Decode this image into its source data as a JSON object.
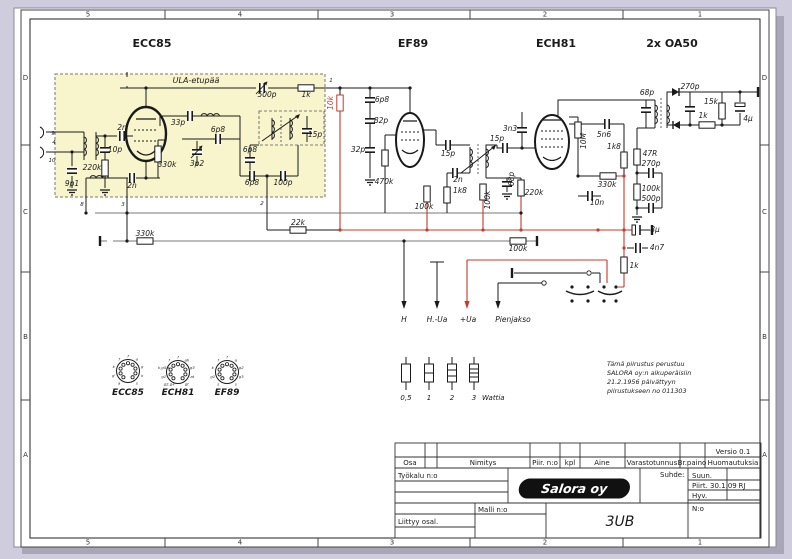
{
  "frame": {
    "zones_top": [
      "5",
      "4",
      "3",
      "2",
      "1"
    ],
    "zones_bottom": [
      "5",
      "4",
      "3",
      "2",
      "1"
    ],
    "zones_left": [
      "D",
      "C",
      "B",
      "A"
    ],
    "zones_right": [
      "D",
      "C",
      "B",
      "A"
    ]
  },
  "tube_titles": [
    {
      "t": "ECC85",
      "x": 152
    },
    {
      "t": "EF89",
      "x": 413
    },
    {
      "t": "ECH81",
      "x": 556
    },
    {
      "t": "2x OA50",
      "x": 672
    }
  ],
  "ula_label": "ULA-etupää",
  "labels": [
    {
      "t": "500p",
      "x": 267,
      "y": 97,
      "sym": "vcaph",
      "sx": 262,
      "sy": 88
    },
    {
      "t": "1k",
      "x": 306,
      "y": 97,
      "sym": "resh",
      "sx": 306,
      "sy": 88
    },
    {
      "t": "10k",
      "x": 333,
      "y": 103,
      "r": -90,
      "c": "red",
      "sym": "resv",
      "sx": 340,
      "sy": 103
    },
    {
      "t": "33p",
      "x": 178,
      "y": 125,
      "sym": "caph",
      "sx": 190,
      "sy": 116
    },
    {
      "t": "6p8",
      "x": 218,
      "y": 132,
      "sym": "caph",
      "sx": 218,
      "sy": 139
    },
    {
      "t": "15p",
      "x": 315,
      "y": 137,
      "sym": "capv",
      "sx": 307,
      "sy": 131
    },
    {
      "t": "2n",
      "x": 122,
      "y": 130,
      "sym": "caph",
      "sx": 122,
      "sy": 136
    },
    {
      "t": "10p",
      "x": 115,
      "y": 152,
      "sym": "capv",
      "sx": 105,
      "sy": 150
    },
    {
      "t": "220k",
      "x": 92,
      "y": 170,
      "sym": "resv",
      "sx": 105,
      "sy": 168
    },
    {
      "t": "330k",
      "x": 167,
      "y": 167,
      "sym": "resv",
      "sx": 158,
      "sy": 154
    },
    {
      "t": "3p2",
      "x": 197,
      "y": 166,
      "sym": "vcapv",
      "sx": 197,
      "sy": 152
    },
    {
      "t": "9p1",
      "x": 72,
      "y": 186,
      "sym": "capv",
      "sx": 72,
      "sy": 171
    },
    {
      "t": "2n",
      "x": 132,
      "y": 188,
      "sym": "caph",
      "sx": 132,
      "sy": 178
    },
    {
      "t": "6p8",
      "x": 250,
      "y": 152,
      "sym": "capv",
      "sx": 250,
      "sy": 160
    },
    {
      "t": "6p8",
      "x": 252,
      "y": 185,
      "sym": "caph",
      "sx": 252,
      "sy": 176
    },
    {
      "t": "100p",
      "x": 283,
      "y": 185,
      "sym": "caph",
      "sx": 283,
      "sy": 176
    },
    {
      "t": "6p8",
      "x": 382,
      "y": 102,
      "sym": "capv",
      "sx": 370,
      "sy": 100
    },
    {
      "t": "82p",
      "x": 381,
      "y": 123,
      "sym": "capv",
      "sx": 370,
      "sy": 121
    },
    {
      "t": "32p",
      "x": 358,
      "y": 152,
      "sym": "capv",
      "sx": 370,
      "sy": 150
    },
    {
      "t": "470k",
      "x": 384,
      "y": 184,
      "sym": "resv",
      "sx": 385,
      "sy": 158
    },
    {
      "t": "100k",
      "x": 424,
      "y": 209,
      "sym": "resv",
      "sx": 427,
      "sy": 194
    },
    {
      "t": "15p",
      "x": 448,
      "y": 156,
      "sym": "caph",
      "sx": 448,
      "sy": 145
    },
    {
      "t": "2n",
      "x": 458,
      "y": 182,
      "sym": "caph",
      "sx": 455,
      "sy": 173
    },
    {
      "t": "1k8",
      "x": 460,
      "y": 193,
      "sym": "resv",
      "sx": 447,
      "sy": 195
    },
    {
      "t": "100k",
      "x": 490,
      "y": 200,
      "r": -90,
      "sym": "resv",
      "sx": 483,
      "sy": 192
    },
    {
      "t": "15p",
      "x": 497,
      "y": 141,
      "sym": "caph",
      "sx": 505,
      "sy": 148
    },
    {
      "t": "3n3",
      "x": 510,
      "y": 131,
      "sym": "capv",
      "sx": 522,
      "sy": 130
    },
    {
      "t": "68p",
      "x": 514,
      "y": 179,
      "r": -90,
      "sym": "capv",
      "sx": 507,
      "sy": 184
    },
    {
      "t": "220k",
      "x": 534,
      "y": 195,
      "sym": "resv",
      "sx": 521,
      "sy": 188
    },
    {
      "t": "10M",
      "x": 586,
      "y": 141,
      "r": -90,
      "sym": "resv",
      "sx": 578,
      "sy": 130
    },
    {
      "t": "5n6",
      "x": 604,
      "y": 137,
      "sym": "caph",
      "sx": 607,
      "sy": 124
    },
    {
      "t": "1k8",
      "x": 614,
      "y": 149,
      "sym": "resv",
      "sx": 624,
      "sy": 160
    },
    {
      "t": "330k",
      "x": 607,
      "y": 187,
      "sym": "resh",
      "sx": 608,
      "sy": 176
    },
    {
      "t": "10n",
      "x": 597,
      "y": 205,
      "sym": "caph",
      "sx": 590,
      "sy": 196
    },
    {
      "t": "68p",
      "x": 647,
      "y": 95,
      "sym": "capv",
      "sx": 646,
      "sy": 110
    },
    {
      "t": "270p",
      "x": 690,
      "y": 89,
      "sym": "capv",
      "sx": 690,
      "sy": 109
    },
    {
      "t": "15k",
      "x": 711,
      "y": 104,
      "sym": "resv",
      "sx": 722,
      "sy": 111
    },
    {
      "t": "1k",
      "x": 703,
      "y": 118,
      "sym": "resh",
      "sx": 707,
      "sy": 125
    },
    {
      "t": "4μ",
      "x": 748,
      "y": 121,
      "sym": "polv",
      "sx": 740,
      "sy": 109
    },
    {
      "t": "47R",
      "x": 650,
      "y": 156,
      "sym": "resv",
      "sx": 637,
      "sy": 157
    },
    {
      "t": "270p",
      "x": 651,
      "y": 166,
      "sym": "caph",
      "sx": 651,
      "sy": 173
    },
    {
      "t": "100k",
      "x": 651,
      "y": 191,
      "sym": "resv",
      "sx": 637,
      "sy": 192
    },
    {
      "t": "500p",
      "x": 651,
      "y": 201,
      "sym": "caph",
      "sx": 651,
      "sy": 208
    },
    {
      "t": "8μ",
      "x": 655,
      "y": 232,
      "sym": "polh",
      "sx": 638,
      "sy": 230
    },
    {
      "t": "4n7",
      "x": 657,
      "y": 250,
      "sym": "caph",
      "sx": 638,
      "sy": 248
    },
    {
      "t": "1k",
      "x": 634,
      "y": 268,
      "sym": "resv",
      "sx": 624,
      "sy": 265
    },
    {
      "t": "22k",
      "x": 298,
      "y": 225,
      "sym": "resh",
      "sx": 298,
      "sy": 230
    },
    {
      "t": "330k",
      "x": 145,
      "y": 236,
      "sym": "resh",
      "sx": 145,
      "sy": 241
    },
    {
      "t": "100k",
      "x": 518,
      "y": 251,
      "sym": "resh",
      "sx": 518,
      "sy": 241
    }
  ],
  "pin_numbers": [
    {
      "t": "1",
      "x": 331,
      "y": 82
    },
    {
      "t": "8",
      "x": 82,
      "y": 206
    },
    {
      "t": "3",
      "x": 123,
      "y": 206
    },
    {
      "t": "2",
      "x": 262,
      "y": 205
    },
    {
      "t": "9",
      "x": 53,
      "y": 135
    },
    {
      "t": "4",
      "x": 54,
      "y": 144
    },
    {
      "t": "10",
      "x": 52,
      "y": 162
    }
  ],
  "outputs": [
    {
      "t": "H",
      "x": 404
    },
    {
      "t": "H.-Ua",
      "x": 437
    },
    {
      "t": "+Ua",
      "x": 468
    },
    {
      "t": "Pienjakso",
      "x": 513
    }
  ],
  "sockets": [
    {
      "name": "ECC85",
      "cx": 128,
      "cy": 371,
      "pins": [
        "k",
        "f",
        "f",
        "a",
        "g",
        "k",
        "s",
        "a",
        "g'"
      ]
    },
    {
      "name": "ECH81",
      "cx": 178,
      "cy": 372,
      "pins": [
        "k,g5,s",
        "f",
        "f",
        "ah",
        "g3",
        "at",
        "gt",
        "g2,g4",
        "g1"
      ]
    },
    {
      "name": "EF89",
      "cx": 227,
      "cy": 372,
      "pins": [
        "k",
        "f",
        "f",
        "a",
        "g2",
        "g3",
        "s",
        "s",
        "g1"
      ]
    }
  ],
  "watt": {
    "values": [
      "0,5",
      "1",
      "2",
      "3"
    ],
    "unit": "Wattia"
  },
  "note": {
    "lines": [
      "Tämä piirustus perustuu",
      "SALORA oy:n alkuperäisiin",
      "21.2.1956 päivättyyn",
      "piirustukseen no 011303"
    ]
  },
  "titleblock": {
    "osa": "Osa",
    "nimitys": "Nimitys",
    "piir_no": "Piir. n:o",
    "kpl": "kpl",
    "aine": "Aine",
    "varastotunnus": "Varastotunnus",
    "br_paino": "Br.paino",
    "huomautuksia": "Huomautuksia",
    "versio": "Versio 0.1",
    "tyokalu": "Työkalu n:o",
    "malli": "Malli n:o",
    "liittyy": "Liittyy osal.",
    "suhde": "Suhde:",
    "suun": "Suun.",
    "piirt": "Piirt. 30.1.09",
    "piirt_init": "RJ",
    "hyv": "Hyv.",
    "no": "N:o",
    "model": "3UB",
    "logo": "Salora oy"
  }
}
